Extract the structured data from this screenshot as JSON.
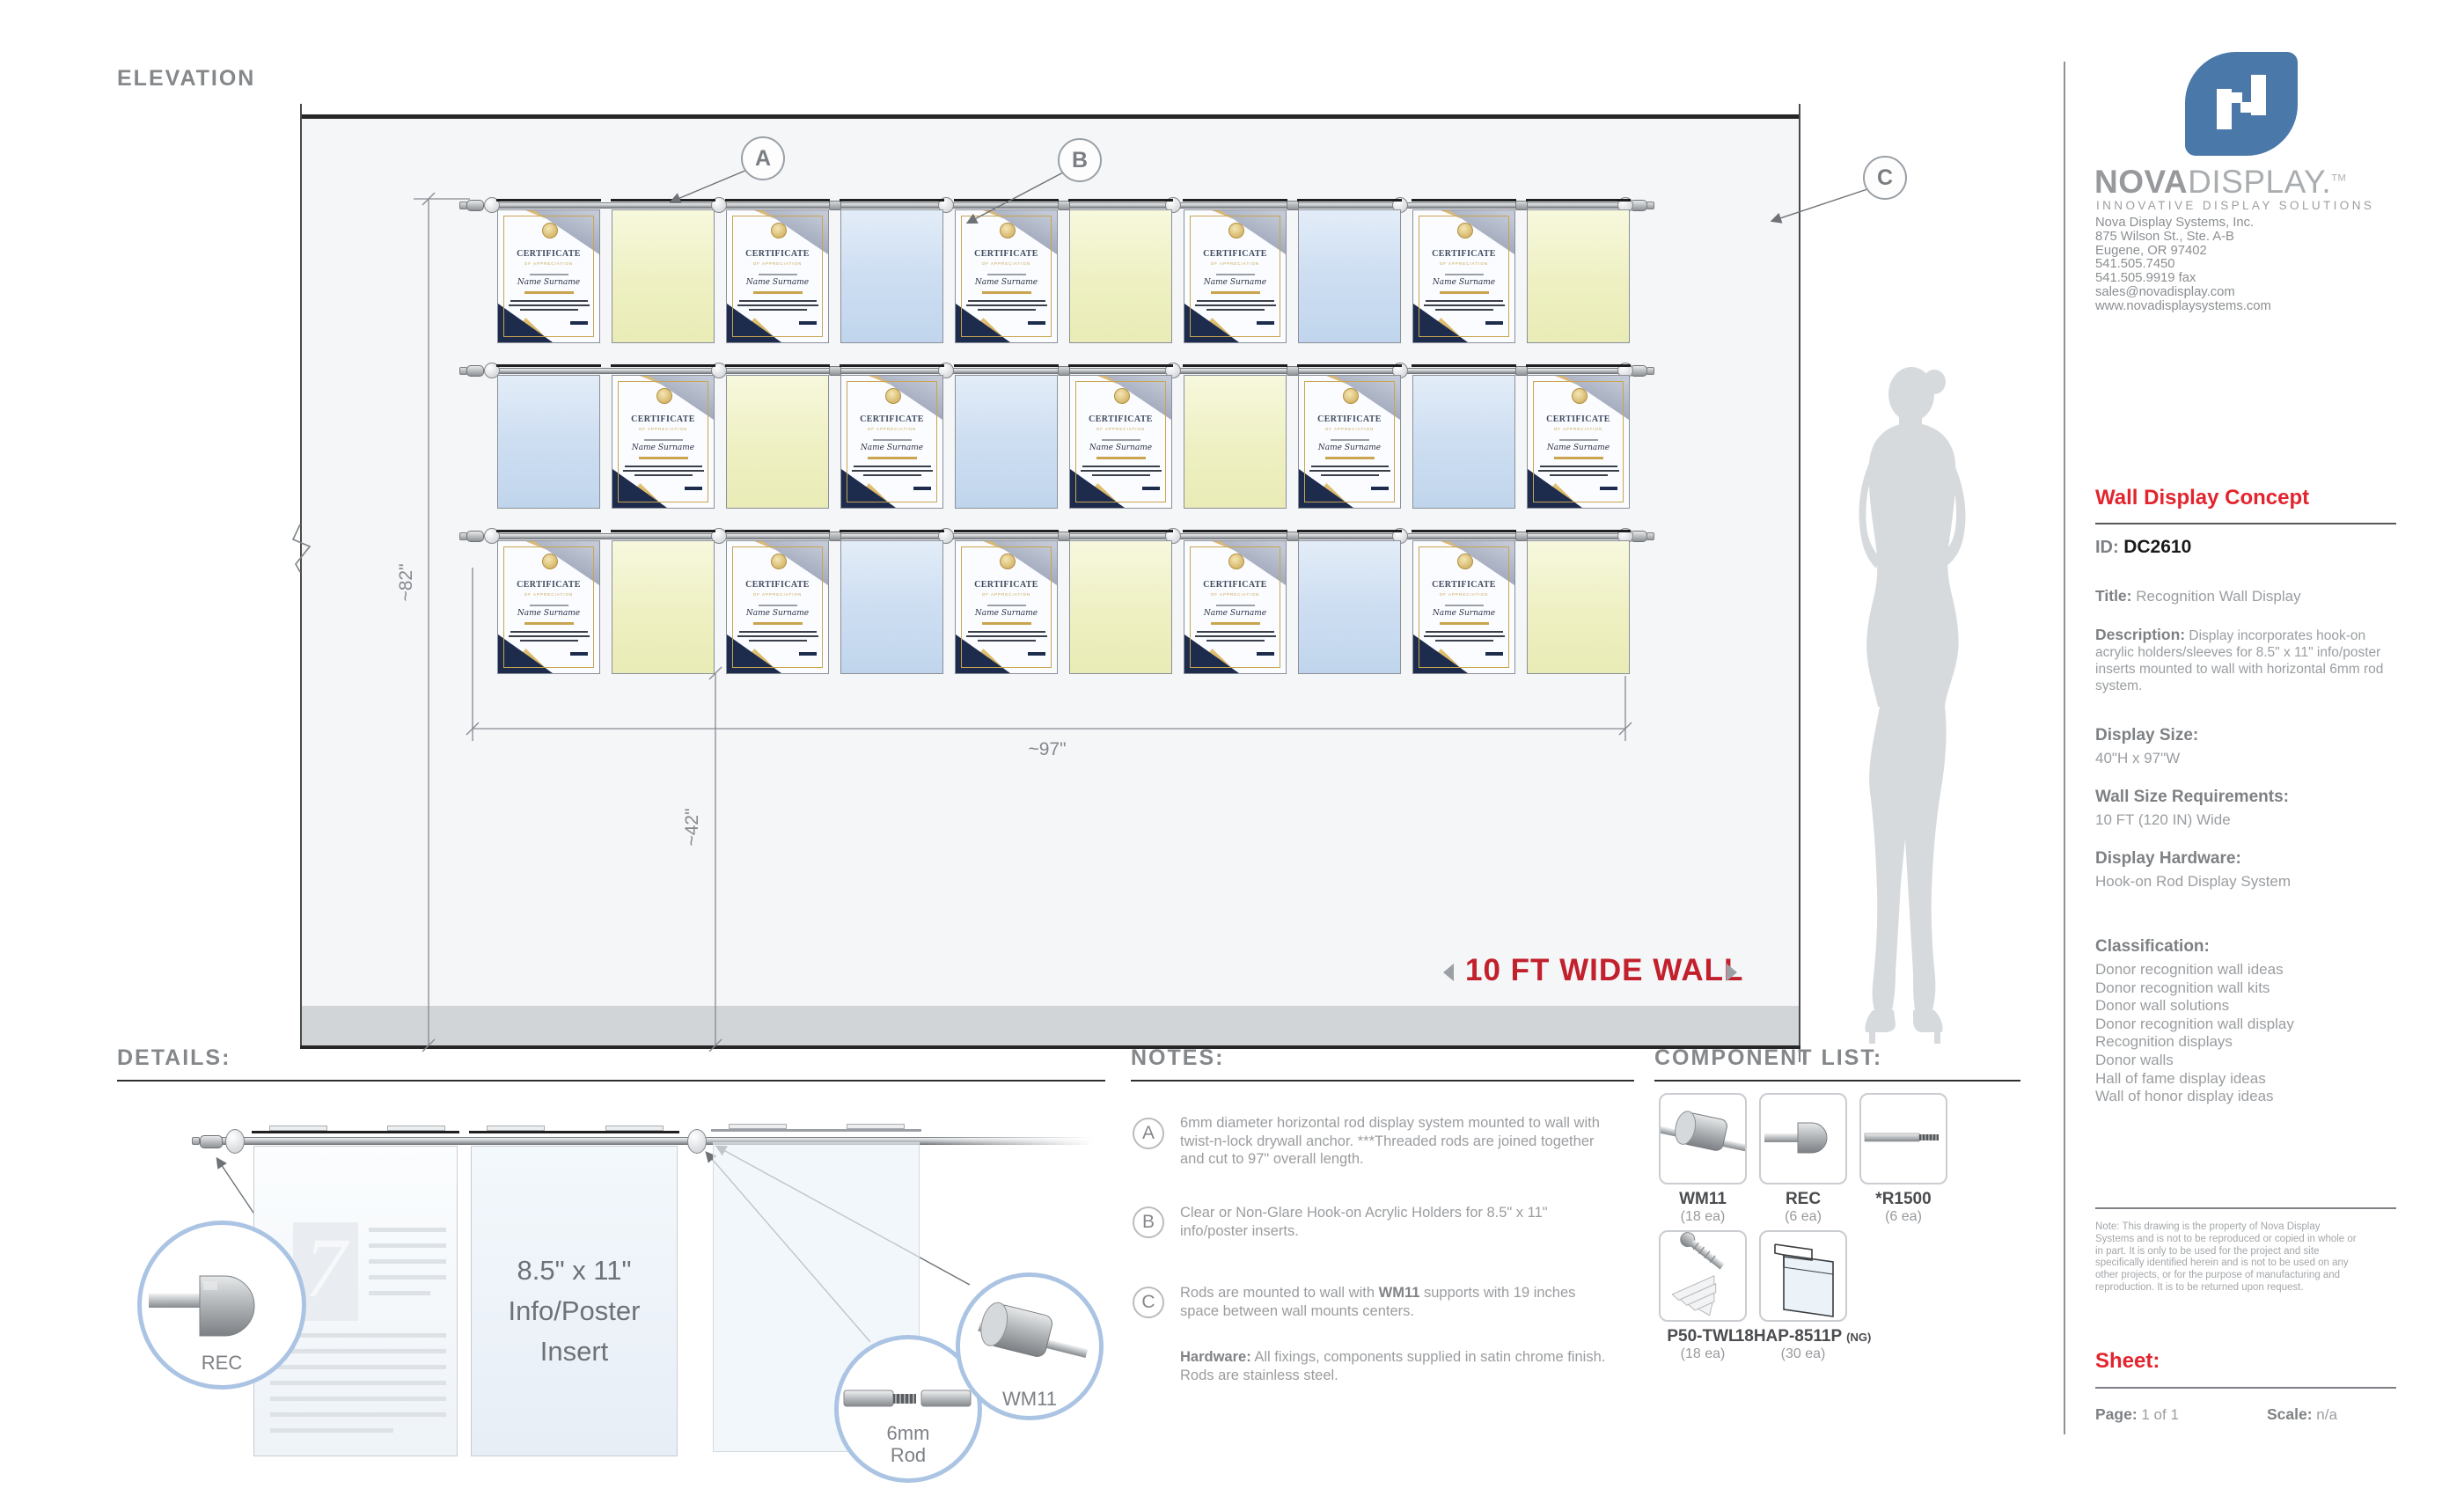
{
  "elevation": {
    "heading": "ELEVATION",
    "wall_label": "10 FT WIDE WALL",
    "dim_height": "~82\"",
    "dim_width": "~97\"",
    "dim_floor": "~42\"",
    "callout_a": "A",
    "callout_b": "B",
    "callout_c": "C",
    "rows": [
      [
        "cert",
        "yellow",
        "cert",
        "blue",
        "cert",
        "yellow",
        "cert",
        "blue",
        "cert",
        "yellow"
      ],
      [
        "blue",
        "cert",
        "yellow",
        "cert",
        "blue",
        "cert",
        "yellow",
        "cert",
        "blue",
        "cert"
      ],
      [
        "cert",
        "yellow",
        "cert",
        "blue",
        "cert",
        "yellow",
        "cert",
        "blue",
        "cert",
        "yellow"
      ]
    ],
    "certificate": {
      "title": "CERTIFICATE",
      "subtitle": "OF APPRECIATION",
      "name": "Name Surname"
    }
  },
  "details": {
    "heading": "DETAILS:",
    "insert_line_1": "8.5\" x 11\"",
    "insert_line_2": "Info/Poster",
    "insert_line_3": "Insert",
    "rec_label": "REC",
    "rod_label_1": "6mm",
    "rod_label_2": "Rod",
    "wm11_label": "WM11"
  },
  "notes": {
    "heading": "NOTES:",
    "a_letter": "A",
    "a_text": "6mm diameter horizontal rod display system mounted to wall with twist-n-lock drywall anchor. ***Threaded rods are joined together and cut to 97\" overall length.",
    "b_letter": "B",
    "b_text": "Clear or Non-Glare Hook-on Acrylic Holders for 8.5\" x 11\" info/poster inserts.",
    "c_letter": "C",
    "c_pre": "Rods are mounted to wall with ",
    "c_bold": "WM11",
    "c_post": " supports with 19 inches space between wall mounts centers.",
    "hw_label": "Hardware:",
    "hw_text": " All fixings, components supplied in satin chrome finish. Rods are stainless steel."
  },
  "components": {
    "heading": "COMPONENT LIST:",
    "items": [
      {
        "name": "WM11",
        "qty": "(18 ea)"
      },
      {
        "name": "REC",
        "qty": "(6 ea)"
      },
      {
        "name": "*R1500",
        "qty": "(6 ea)"
      },
      {
        "name": "P50-TWL",
        "qty": "(18 ea)"
      },
      {
        "name": "18HAP-8511P",
        "suffix": "(NG)",
        "qty": "(30 ea)"
      }
    ]
  },
  "sidebar": {
    "brand_bold": "NOVA",
    "brand_light": "DISPLAY.",
    "brand_tm": "TM",
    "tagline": "INNOVATIVE DISPLAY SOLUTIONS",
    "address_1": "Nova Display Systems, Inc.",
    "address_2": "875 Wilson St., Ste. A-B",
    "address_3": "Eugene, OR 97402",
    "address_4": "541.505.7450",
    "address_5": "541.505.9919 fax",
    "address_6": "sales@novadisplay.com",
    "address_7": "www.novadisplaysystems.com",
    "concept_title": "Wall Display Concept",
    "id_label": "ID: ",
    "id_value": "DC2610",
    "title_label": "Title:",
    "title_value": " Recognition Wall Display",
    "desc_label": "Description:",
    "desc_value": " Display incorporates hook-on acrylic holders/sleeves for 8.5\" x 11\" info/poster inserts mounted to wall with horizontal 6mm rod system.",
    "size_label": "Display Size:",
    "size_value": "40\"H x 97\"W",
    "wallsize_label": "Wall Size Requirements:",
    "wallsize_value": "10 FT (120 IN) Wide",
    "hardware_label": "Display Hardware:",
    "hardware_value": "Hook-on Rod Display System",
    "class_label": "Classification:",
    "classifications": [
      "Donor recognition wall ideas",
      "Donor recognition wall kits",
      "Donor wall solutions",
      "Donor recognition wall display",
      "Recognition displays",
      "Donor walls",
      "Hall of fame display ideas",
      "Wall of honor display ideas"
    ],
    "note": "Note: This drawing is the property of Nova Display Systems and is not to be reproduced or copied in whole or in part. It is only to be used for the project and site specifically identified herein and is not to be used on any other projects, or for the purpose of manufacturing and reproduction. It is to be returned upon request.",
    "sheet_label": "Sheet:",
    "page_label": "Page:",
    "page_value": " 1 of 1",
    "scale_label": "Scale:",
    "scale_value": " n/a"
  }
}
